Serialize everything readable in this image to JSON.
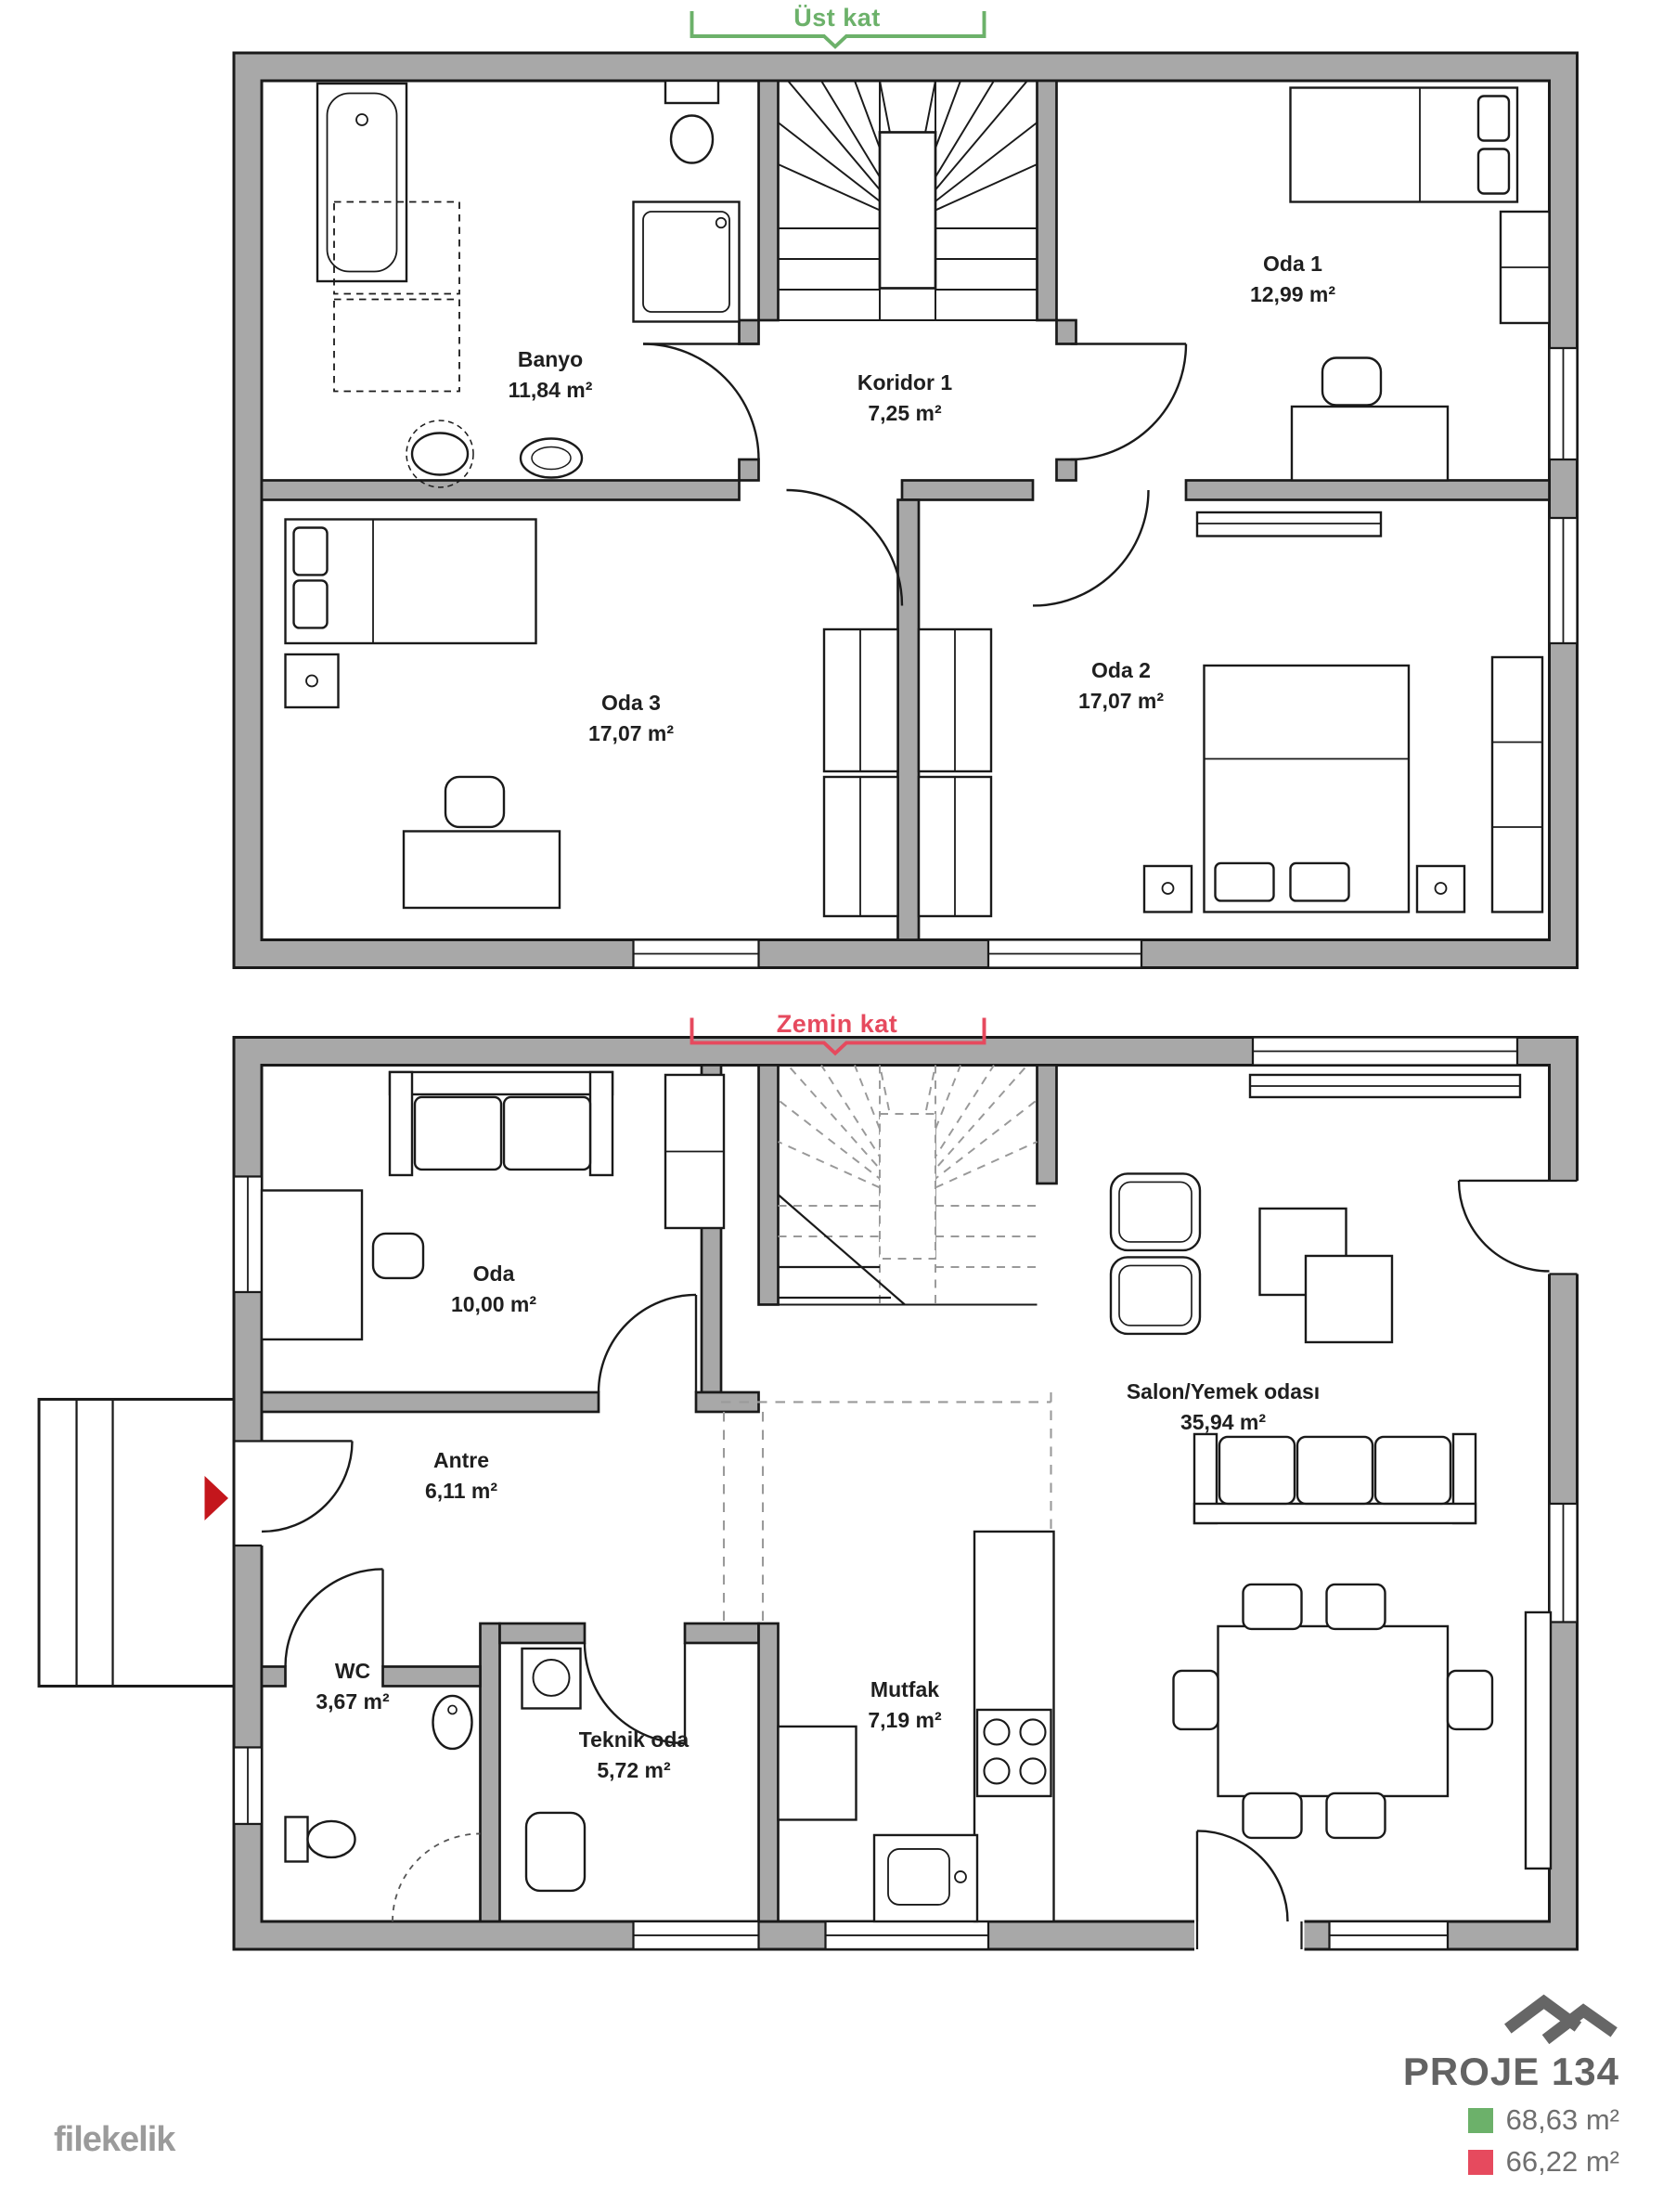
{
  "floors": {
    "upper": {
      "label": "Üst kat",
      "label_color": "#6cb16a",
      "rooms": {
        "banyo": {
          "name": "Banyo",
          "area": "11,84 m²"
        },
        "koridor1": {
          "name": "Koridor 1",
          "area": "7,25 m²"
        },
        "oda1": {
          "name": "Oda 1",
          "area": "12,99 m²"
        },
        "oda3": {
          "name": "Oda 3",
          "area": "17,07 m²"
        },
        "oda2": {
          "name": "Oda 2",
          "area": "17,07 m²"
        }
      }
    },
    "ground": {
      "label": "Zemin kat",
      "label_color": "#e64a5e",
      "rooms": {
        "oda": {
          "name": "Oda",
          "area": "10,00 m²"
        },
        "antre": {
          "name": "Antre",
          "area": "6,11 m²"
        },
        "wc": {
          "name": "WC",
          "area": "3,67 m²"
        },
        "teknik": {
          "name": "Teknik oda",
          "area": "5,72 m²"
        },
        "mutfak": {
          "name": "Mutfak",
          "area": "7,19 m²"
        },
        "salon": {
          "name": "Salon/Yemek odası",
          "area": "35,94 m²"
        }
      }
    }
  },
  "project": {
    "title": "PROJE 134",
    "legend": {
      "upper": {
        "color": "#6cb16a",
        "area": "68,63 m²"
      },
      "ground": {
        "color": "#e64a5e",
        "area": "66,22 m²"
      }
    }
  },
  "brand": {
    "watermark": "filekelik"
  },
  "colors": {
    "wall": "#a8a8a8",
    "outline": "#1a1a1a",
    "entry_arrow": "#c4161c",
    "logo_gray": "#666666",
    "watermark_gray": "#9b9b9b"
  }
}
